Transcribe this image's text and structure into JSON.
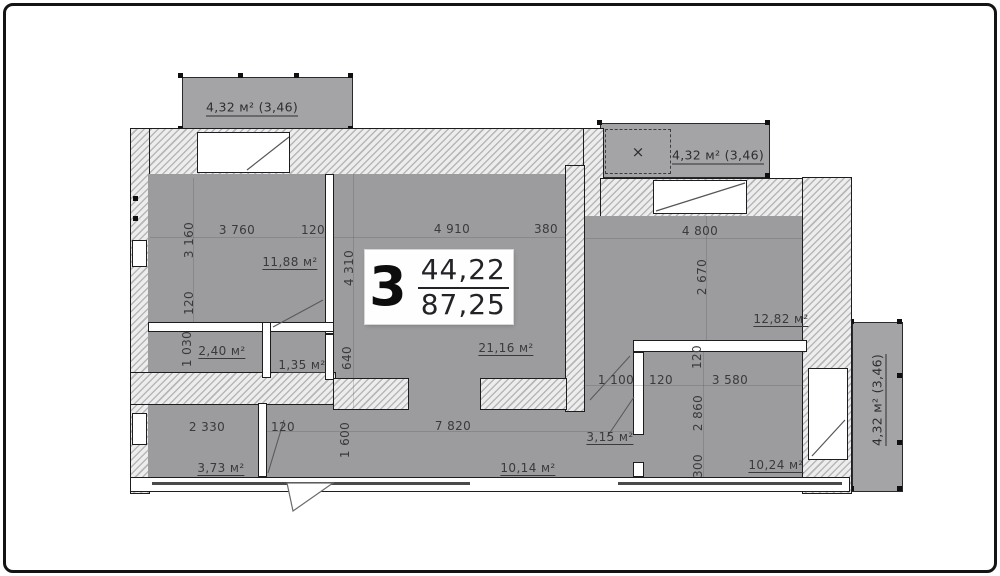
{
  "colors": {
    "room_fill": "#9c9c9e",
    "balcony_fill": "#a4a4a6",
    "wall_dark": "#1d1d1f",
    "hatch_bg": "#ededee",
    "hatch_line": "#b7b7b9",
    "text": "#3a3a3c"
  },
  "unit_label": {
    "rooms_count": "3",
    "upper_area": "44,22",
    "lower_area": "87,25"
  },
  "balconies": {
    "top_left": "4,32 м² (3,46)",
    "top_right": "4,32 м² (3,46)",
    "right": "4,32 м² (3,46)",
    "cross_mark": "×"
  },
  "labels": {
    "dim_3760": "3 760",
    "dim_120_a": "120",
    "dim_3160": "3 160",
    "dim_120_b": "120",
    "area_tl": "11,88 м²",
    "dim_4910": "4 910",
    "dim_380": "380",
    "dim_4310": "4 310",
    "dim_640": "640",
    "area_living": "21,16 м²",
    "dim_4800": "4 800",
    "dim_2670": "2 670",
    "area_right": "12,82 м²",
    "dim_1030": "1 030",
    "area_bath": "2,40 м²",
    "area_hall_small": "1,35 м²",
    "dim_2330": "2 330",
    "dim_120_c": "120",
    "area_bl": "3,73 м²",
    "dim_1600": "1 600",
    "dim_7820": "7 820",
    "area_corridor": "10,14 м²",
    "area_hall_right": "3,15 м²",
    "dim_1100": "1 100",
    "dim_120_d": "120",
    "dim_3580": "3 580",
    "dim_120_e": "120",
    "dim_2860": "2 860",
    "dim_300": "300",
    "area_br": "10,24 м²"
  }
}
